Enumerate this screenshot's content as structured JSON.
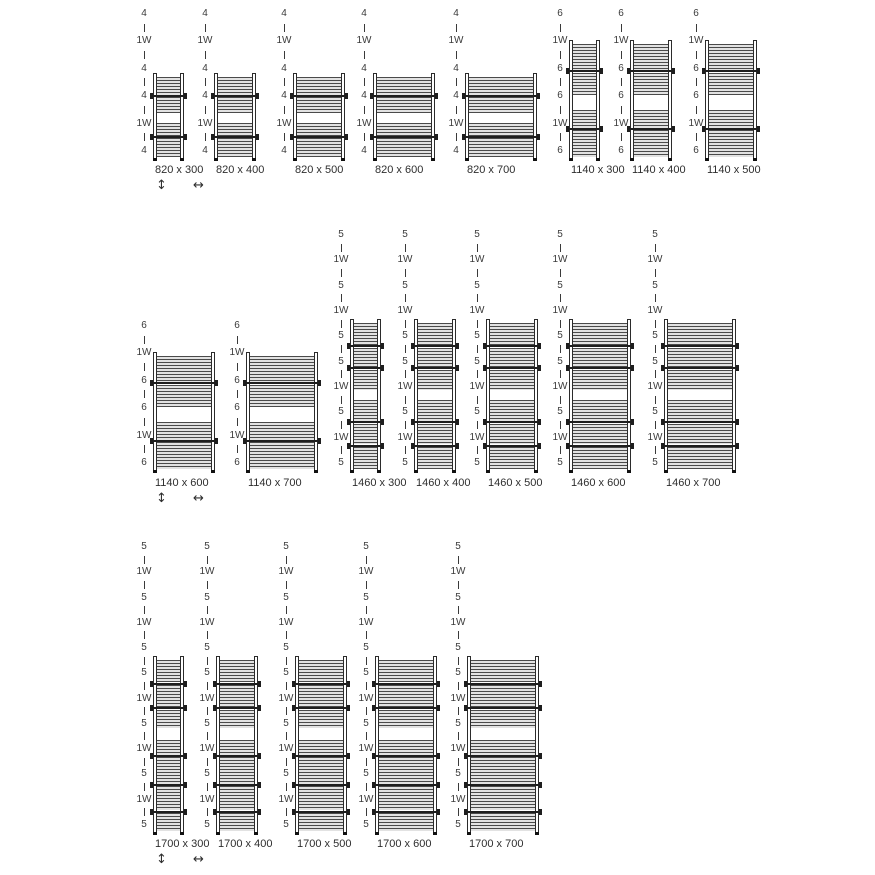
{
  "legend": {
    "height_arrow": "↕",
    "width_arrow": "↔"
  },
  "colors": {
    "background": "#ffffff",
    "ink": "#2e2e2e",
    "tube_dark": "#4a4a4a",
    "tube_light": "#e2e2e2"
  },
  "models": {
    "m820": {
      "height_mm": 820,
      "tube_pattern": [
        "4",
        "1W",
        "4",
        "4",
        "1W",
        "4"
      ],
      "sections": [
        {
          "type": "tubes",
          "h": 23
        },
        {
          "type": "bracket",
          "h": 2.5
        },
        {
          "type": "tubes",
          "h": 19.5
        },
        {
          "type": "towel-gap",
          "h": 13
        },
        {
          "type": "tubes",
          "h": 16
        },
        {
          "type": "bracket",
          "h": 2.5
        },
        {
          "type": "tubes",
          "h": 23.5
        }
      ]
    },
    "m1140": {
      "height_mm": 1140,
      "tube_pattern": [
        "6",
        "1W",
        "6",
        "6",
        "1W",
        "6"
      ],
      "sections": [
        {
          "type": "tubes",
          "h": 23
        },
        {
          "type": "bracket",
          "h": 2.5
        },
        {
          "type": "tubes",
          "h": 19.5
        },
        {
          "type": "towel-gap",
          "h": 13
        },
        {
          "type": "tubes",
          "h": 16
        },
        {
          "type": "bracket",
          "h": 2.5
        },
        {
          "type": "tubes",
          "h": 23.5
        }
      ]
    },
    "m1460": {
      "height_mm": 1460,
      "tube_pattern": [
        "5",
        "1W",
        "5",
        "1W",
        "5",
        "5",
        "1W",
        "5",
        "1W",
        "5"
      ],
      "sections": [
        {
          "type": "tubes",
          "h": 15
        },
        {
          "type": "bracket",
          "h": 2
        },
        {
          "type": "tubes",
          "h": 13
        },
        {
          "type": "bracket",
          "h": 2
        },
        {
          "type": "tubes",
          "h": 14
        },
        {
          "type": "towel-gap",
          "h": 7
        },
        {
          "type": "tubes",
          "h": 14
        },
        {
          "type": "bracket",
          "h": 2
        },
        {
          "type": "tubes",
          "h": 14
        },
        {
          "type": "bracket",
          "h": 2
        },
        {
          "type": "tubes",
          "h": 15
        }
      ]
    },
    "m1700": {
      "height_mm": 1700,
      "tube_pattern": [
        "5",
        "1W",
        "5",
        "1W",
        "5",
        "5",
        "1W",
        "5",
        "1W",
        "5",
        "1W",
        "5"
      ],
      "sections": [
        {
          "type": "tubes",
          "h": 13
        },
        {
          "type": "bracket",
          "h": 1.5
        },
        {
          "type": "tubes",
          "h": 13
        },
        {
          "type": "bracket",
          "h": 1.5
        },
        {
          "type": "tubes",
          "h": 11
        },
        {
          "type": "towel-gap",
          "h": 7
        },
        {
          "type": "tubes",
          "h": 8.5
        },
        {
          "type": "bracket",
          "h": 1.5
        },
        {
          "type": "tubes",
          "h": 15.5
        },
        {
          "type": "bracket",
          "h": 1.5
        },
        {
          "type": "tubes",
          "h": 14
        },
        {
          "type": "bracket",
          "h": 1.5
        },
        {
          "type": "tubes",
          "h": 10.5
        }
      ]
    }
  },
  "rows": [
    {
      "units": [
        {
          "model": "m820",
          "width_mm": 300,
          "size": "820 x 300",
          "show_arrows": true
        },
        {
          "model": "m820",
          "width_mm": 400,
          "size": "820 x 400"
        },
        {
          "model": "m820",
          "width_mm": 500,
          "size": "820 x 500"
        },
        {
          "model": "m820",
          "width_mm": 600,
          "size": "820 x 600"
        },
        {
          "model": "m820",
          "width_mm": 700,
          "size": "820 x 700"
        },
        {
          "model": "m1140",
          "width_mm": 300,
          "size": "1140 x 300"
        },
        {
          "model": "m1140",
          "width_mm": 400,
          "size": "1140 x 400"
        },
        {
          "model": "m1140",
          "width_mm": 500,
          "size": "1140 x 500"
        }
      ]
    },
    {
      "units": [
        {
          "model": "m1140",
          "width_mm": 600,
          "size": "1140 x 600",
          "show_arrows": true
        },
        {
          "model": "m1140",
          "width_mm": 700,
          "size": "1140 x 700"
        },
        {
          "model": "m1460",
          "width_mm": 300,
          "size": "1460 x 300"
        },
        {
          "model": "m1460",
          "width_mm": 400,
          "size": "1460 x 400"
        },
        {
          "model": "m1460",
          "width_mm": 500,
          "size": "1460 x 500"
        },
        {
          "model": "m1460",
          "width_mm": 600,
          "size": "1460 x 600"
        },
        {
          "model": "m1460",
          "width_mm": 700,
          "size": "1460 x 700"
        }
      ]
    },
    {
      "units": [
        {
          "model": "m1700",
          "width_mm": 300,
          "size": "1700 x 300",
          "show_arrows": true
        },
        {
          "model": "m1700",
          "width_mm": 400,
          "size": "1700 x 400"
        },
        {
          "model": "m1700",
          "width_mm": 500,
          "size": "1700 x 500"
        },
        {
          "model": "m1700",
          "width_mm": 600,
          "size": "1700 x 600"
        },
        {
          "model": "m1700",
          "width_mm": 700,
          "size": "1700 x 700"
        }
      ]
    }
  ]
}
